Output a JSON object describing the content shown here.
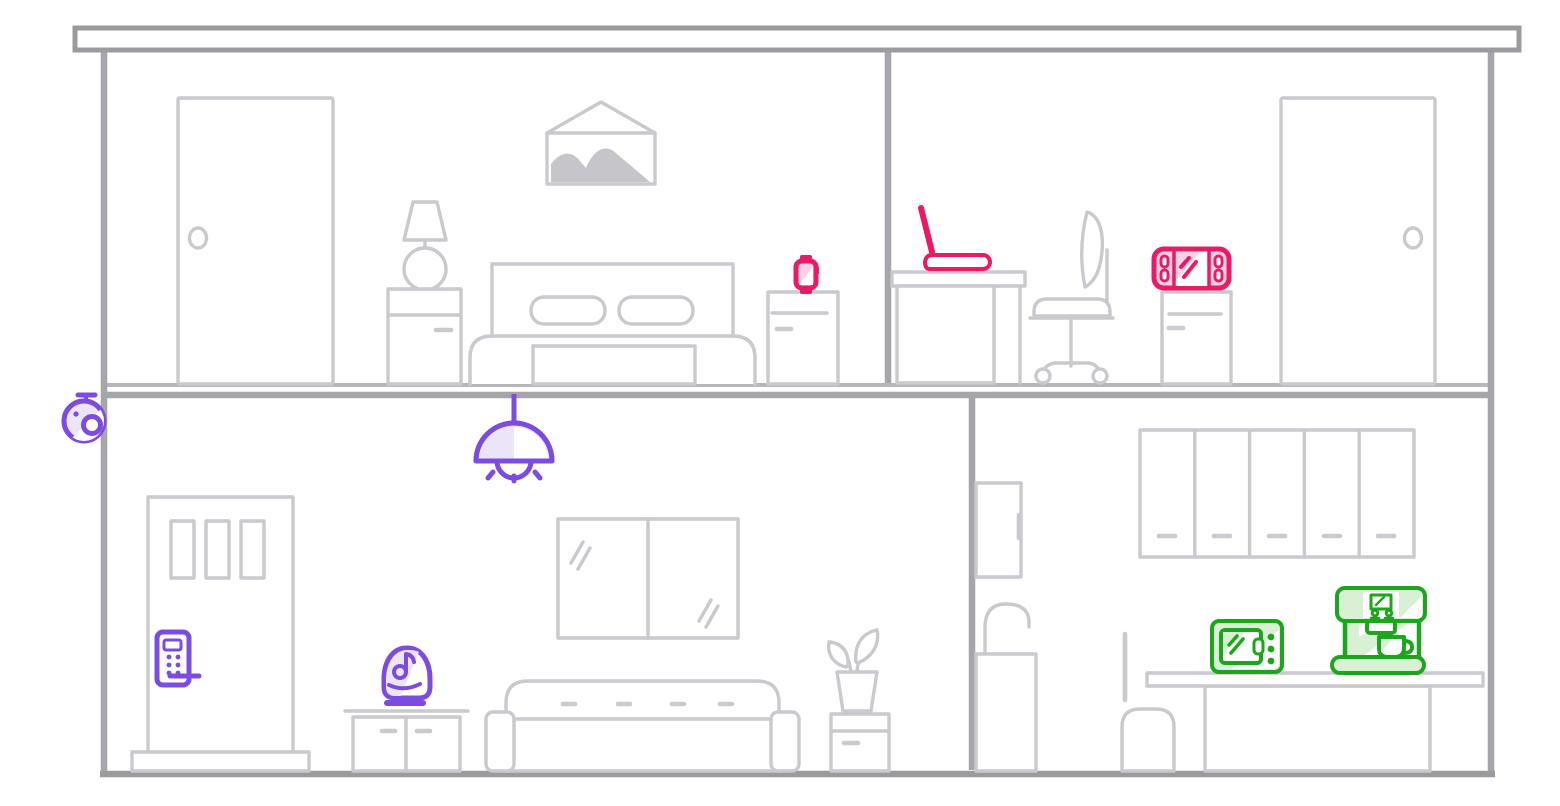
{
  "colors": {
    "canvas": "#ffffff",
    "structure": "#a6a6aa",
    "structure-dark": "#9b9b9f",
    "structure-light": "#b7b7bb",
    "furniture": "#c9c9ce",
    "furniture-fill": "#c5c5ca",
    "pink": "#eb1a64",
    "pink-light": "#fad2e5",
    "purple": "#7c4be0",
    "purple-light": "#ece4f9",
    "green": "#1ea51e",
    "green-light": "#d9f0d5"
  },
  "rooms": {
    "bedroom": {
      "name": "Bedroom"
    },
    "office": {
      "name": "Office"
    },
    "living_room": {
      "name": "Living room"
    },
    "kitchen": {
      "name": "Kitchen"
    }
  },
  "devices": {
    "security_camera": {
      "label": "Security camera",
      "location": "exterior wall",
      "color": "purple"
    },
    "smartwatch": {
      "label": "Smartwatch",
      "location": "bedroom",
      "color": "pink"
    },
    "laptop": {
      "label": "Laptop",
      "location": "office",
      "color": "pink"
    },
    "game_console": {
      "label": "Game console",
      "location": "office",
      "color": "pink"
    },
    "pendant_light": {
      "label": "Pendant light",
      "location": "living room",
      "color": "purple"
    },
    "smart_lock": {
      "label": "Smart door lock",
      "location": "living room",
      "color": "purple"
    },
    "smart_speaker": {
      "label": "Smart speaker",
      "location": "living room",
      "color": "purple"
    },
    "microwave": {
      "label": "Microwave",
      "location": "kitchen",
      "color": "green"
    },
    "coffee_machine": {
      "label": "Coffee machine",
      "location": "kitchen",
      "color": "green"
    }
  }
}
